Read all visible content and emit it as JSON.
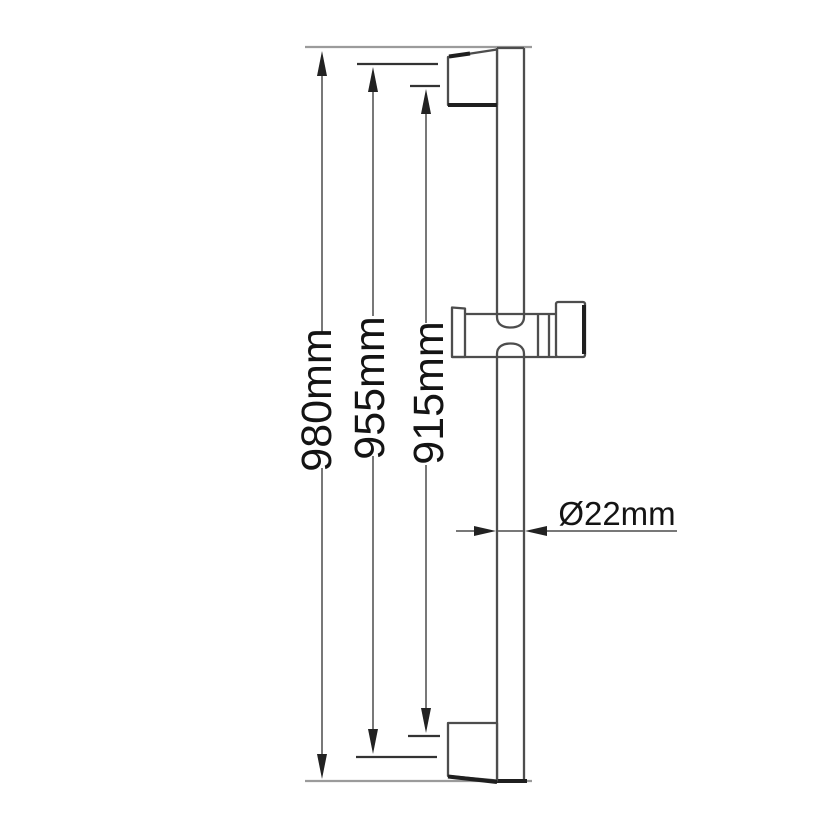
{
  "dimensions": {
    "overall": {
      "label": "980mm"
    },
    "outer": {
      "label": "955mm"
    },
    "inner": {
      "label": "915mm"
    },
    "diameter": {
      "label": "Ø22mm"
    }
  },
  "colors": {
    "background": "#ffffff",
    "outline": "#4d4d4d",
    "outline_shadow": "#1f1f1f",
    "extension_line": "#9b9b9b",
    "dimension_line": "#787878",
    "tick": "#333333",
    "arrow": "#222222",
    "text": "#141414"
  }
}
